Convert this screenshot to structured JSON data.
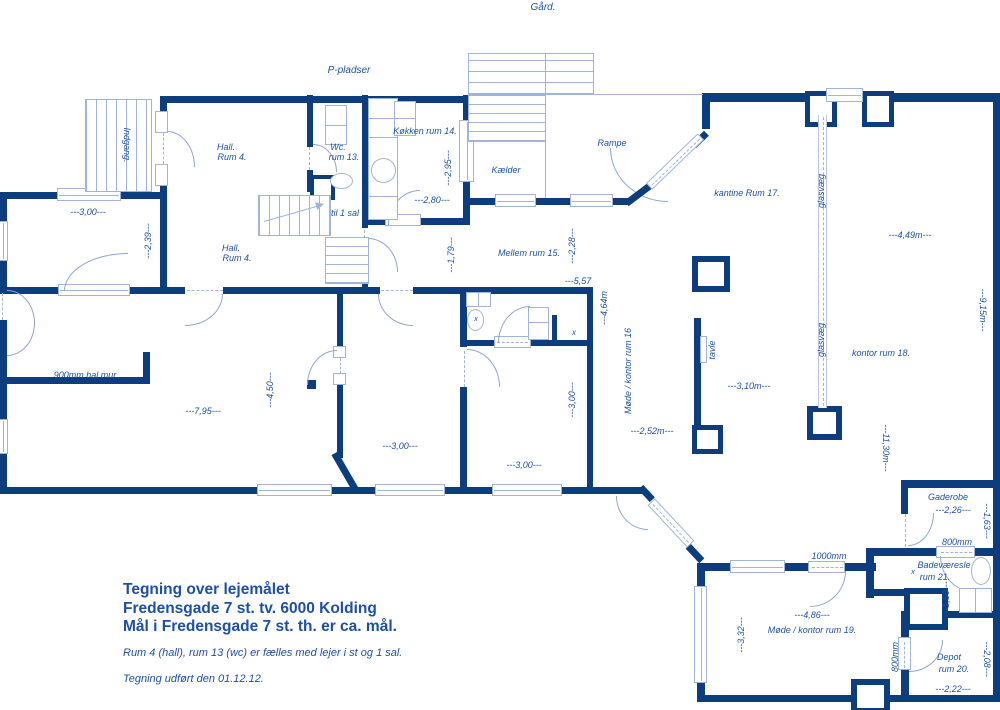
{
  "colors": {
    "wall": "#0d3d7c",
    "thin_line": "#9fb4d8",
    "text": "#1e50a8"
  },
  "title_block": {
    "line1": "Tegning over lejemålet",
    "line2": "Fredensgade 7 st. tv. 6000 Kolding",
    "line3": "Mål i Fredensgade 7 st. th. er ca. mål.",
    "note1": "Rum 4 (hall), rum 13 (wc) er fælles med lejer i st og 1 sal.",
    "note2": "Tegning udført den 01.12.12."
  },
  "labels": [
    {
      "name": "label-gaard",
      "text": "Gård.",
      "x": 543,
      "y": 8,
      "rot": 0,
      "size": 10
    },
    {
      "name": "label-p-pladser",
      "text": "P-pladser",
      "x": 349,
      "y": 71,
      "rot": 0,
      "size": 10
    },
    {
      "name": "label-indgang",
      "text": "Indgang.",
      "x": 127,
      "y": 145,
      "rot": 90,
      "size": 9
    },
    {
      "name": "label-hall-rum4-top-1",
      "text": "Hall.",
      "x": 226,
      "y": 147,
      "rot": 0,
      "size": 9
    },
    {
      "name": "label-hall-rum4-top-2",
      "text": "Rum 4.",
      "x": 232,
      "y": 157,
      "rot": 0,
      "size": 9
    },
    {
      "name": "label-wc-1",
      "text": "Wc.",
      "x": 338,
      "y": 147,
      "rot": 0,
      "size": 9
    },
    {
      "name": "label-wc-2",
      "text": "rum 13.",
      "x": 344,
      "y": 157,
      "rot": 0,
      "size": 9
    },
    {
      "name": "label-koekken",
      "text": "Køkken rum 14.",
      "x": 425,
      "y": 131,
      "rot": 0,
      "size": 9
    },
    {
      "name": "dim-2-95",
      "text": "---2,95---",
      "x": 448,
      "y": 168,
      "rot": -90,
      "size": 9
    },
    {
      "name": "dim-2-80",
      "text": "---2,80---",
      "x": 432,
      "y": 200,
      "rot": 0,
      "size": 9
    },
    {
      "name": "label-kaelder",
      "text": "Kælder",
      "x": 506,
      "y": 170,
      "rot": 0,
      "size": 9
    },
    {
      "name": "label-rampe",
      "text": "Rampe",
      "x": 612,
      "y": 143,
      "rot": 0,
      "size": 9
    },
    {
      "name": "dim-3-00-left",
      "text": "---3,00---",
      "x": 88,
      "y": 212,
      "rot": 0,
      "size": 9
    },
    {
      "name": "dim-2-39",
      "text": "---2,39---",
      "x": 148,
      "y": 241,
      "rot": -90,
      "size": 9
    },
    {
      "name": "label-hall-rum4-mid-1",
      "text": "Hall.",
      "x": 231,
      "y": 248,
      "rot": 0,
      "size": 9
    },
    {
      "name": "label-hall-rum4-mid-2",
      "text": "Rum 4.",
      "x": 237,
      "y": 258,
      "rot": 0,
      "size": 9
    },
    {
      "name": "label-til-1-sal",
      "text": "til 1 sal",
      "x": 345,
      "y": 213,
      "rot": 0,
      "size": 9
    },
    {
      "name": "dim-1-79",
      "text": "---1,79---",
      "x": 451,
      "y": 255,
      "rot": -90,
      "size": 9
    },
    {
      "name": "label-mellem-rum15",
      "text": "Mellem rum 15.",
      "x": 529,
      "y": 253,
      "rot": 0,
      "size": 9
    },
    {
      "name": "dim-2-28",
      "text": "---2,28---",
      "x": 572,
      "y": 246,
      "rot": -90,
      "size": 9
    },
    {
      "name": "dim-5-57",
      "text": "---5,57",
      "x": 578,
      "y": 281,
      "rot": 0,
      "size": 9
    },
    {
      "name": "dim-4-64",
      "text": "---4,64m",
      "x": 604,
      "y": 308,
      "rot": -90,
      "size": 9
    },
    {
      "name": "label-kantine-rum17",
      "text": "kantine Rum 17.",
      "x": 747,
      "y": 193,
      "rot": 0,
      "size": 9
    },
    {
      "name": "label-glasvaeg-1",
      "text": "glasvæg",
      "x": 821,
      "y": 191,
      "rot": -90,
      "size": 9
    },
    {
      "name": "label-glasvaeg-2",
      "text": "glasvæg",
      "x": 821,
      "y": 340,
      "rot": -90,
      "size": 9
    },
    {
      "name": "dim-4-49",
      "text": "---4,49m---",
      "x": 910,
      "y": 235,
      "rot": 0,
      "size": 9
    },
    {
      "name": "dim-9-15",
      "text": "---9,15m---",
      "x": 983,
      "y": 310,
      "rot": 90,
      "size": 9
    },
    {
      "name": "label-kontor-rum18",
      "text": "kontor rum 18.",
      "x": 881,
      "y": 353,
      "rot": 0,
      "size": 9
    },
    {
      "name": "label-tavle",
      "text": "tavle",
      "x": 712,
      "y": 350,
      "rot": -90,
      "size": 9
    },
    {
      "name": "dim-3-10",
      "text": "---3,10m---",
      "x": 749,
      "y": 386,
      "rot": 0,
      "size": 9
    },
    {
      "name": "label-moede-kontor-rum16",
      "text": "Møde / kontor rum 16",
      "x": 628,
      "y": 371,
      "rot": -90,
      "size": 9
    },
    {
      "name": "dim-11-30",
      "text": "---11,30m---",
      "x": 886,
      "y": 448,
      "rot": 90,
      "size": 9
    },
    {
      "name": "dim-2-52",
      "text": "---2,52m---",
      "x": 652,
      "y": 431,
      "rot": 0,
      "size": 9
    },
    {
      "name": "mark-x-toilet",
      "text": "x",
      "x": 476,
      "y": 320,
      "rot": 0,
      "size": 7
    },
    {
      "name": "mark-x-wall",
      "text": "x",
      "x": 574,
      "y": 333,
      "rot": 0,
      "size": 8
    },
    {
      "name": "dim-900mm-hal-mur",
      "text": "900mm hal mur",
      "x": 85,
      "y": 375,
      "rot": 0,
      "size": 9
    },
    {
      "name": "dim-7-95",
      "text": "---7,95---",
      "x": 203,
      "y": 411,
      "rot": 0,
      "size": 9
    },
    {
      "name": "dim-4-50",
      "text": "---4,50---",
      "x": 270,
      "y": 390,
      "rot": -90,
      "size": 9
    },
    {
      "name": "dim-3-00-a",
      "text": "---3,00---",
      "x": 400,
      "y": 446,
      "rot": 0,
      "size": 9
    },
    {
      "name": "dim-3-00-b",
      "text": "---3,00---",
      "x": 524,
      "y": 465,
      "rot": 0,
      "size": 9
    },
    {
      "name": "dim-3-00-v",
      "text": "---3,00---",
      "x": 572,
      "y": 400,
      "rot": -90,
      "size": 9
    },
    {
      "name": "label-gaderobe",
      "text": "Gaderobe",
      "x": 948,
      "y": 497,
      "rot": 0,
      "size": 9
    },
    {
      "name": "dim-2-26",
      "text": "---2,26---",
      "x": 953,
      "y": 510,
      "rot": 0,
      "size": 9
    },
    {
      "name": "dim-1-63",
      "text": "---1,63---",
      "x": 987,
      "y": 521,
      "rot": 90,
      "size": 9
    },
    {
      "name": "dim-800mm-bad",
      "text": "800mm",
      "x": 957,
      "y": 542,
      "rot": 0,
      "size": 9
    },
    {
      "name": "label-badevaeresle",
      "text": "Badeværesle",
      "x": 944,
      "y": 565,
      "rot": 0,
      "size": 9
    },
    {
      "name": "mark-x-bad",
      "text": "x",
      "x": 913,
      "y": 573,
      "rot": 0,
      "size": 7
    },
    {
      "name": "label-rum21",
      "text": "rum 21.",
      "x": 935,
      "y": 577,
      "rot": 0,
      "size": 9
    },
    {
      "name": "dim-1-50",
      "text": "---1,50---",
      "x": 946,
      "y": 599,
      "rot": -90,
      "size": 9
    },
    {
      "name": "dim-1000mm",
      "text": "1000mm",
      "x": 829,
      "y": 556,
      "rot": 0,
      "size": 9
    },
    {
      "name": "dim-4-86",
      "text": "---4,86---",
      "x": 812,
      "y": 615,
      "rot": 0,
      "size": 9
    },
    {
      "name": "label-moede-kontor-rum19",
      "text": "Møde / kontor rum 19.",
      "x": 812,
      "y": 630,
      "rot": 0,
      "size": 9
    },
    {
      "name": "dim-3-32",
      "text": "---3,32---",
      "x": 741,
      "y": 635,
      "rot": -90,
      "size": 9
    },
    {
      "name": "dim-800mm-depot",
      "text": "800mm",
      "x": 895,
      "y": 657,
      "rot": -90,
      "size": 9
    },
    {
      "name": "label-depot-1",
      "text": "Depot",
      "x": 949,
      "y": 657,
      "rot": 0,
      "size": 9
    },
    {
      "name": "label-depot-2",
      "text": "rum 20.",
      "x": 954,
      "y": 669,
      "rot": 0,
      "size": 9
    },
    {
      "name": "dim-2-08",
      "text": "---2,08---",
      "x": 987,
      "y": 659,
      "rot": 90,
      "size": 9
    },
    {
      "name": "dim-2-22",
      "text": "---2,22---",
      "x": 953,
      "y": 689,
      "rot": 0,
      "size": 9
    }
  ]
}
